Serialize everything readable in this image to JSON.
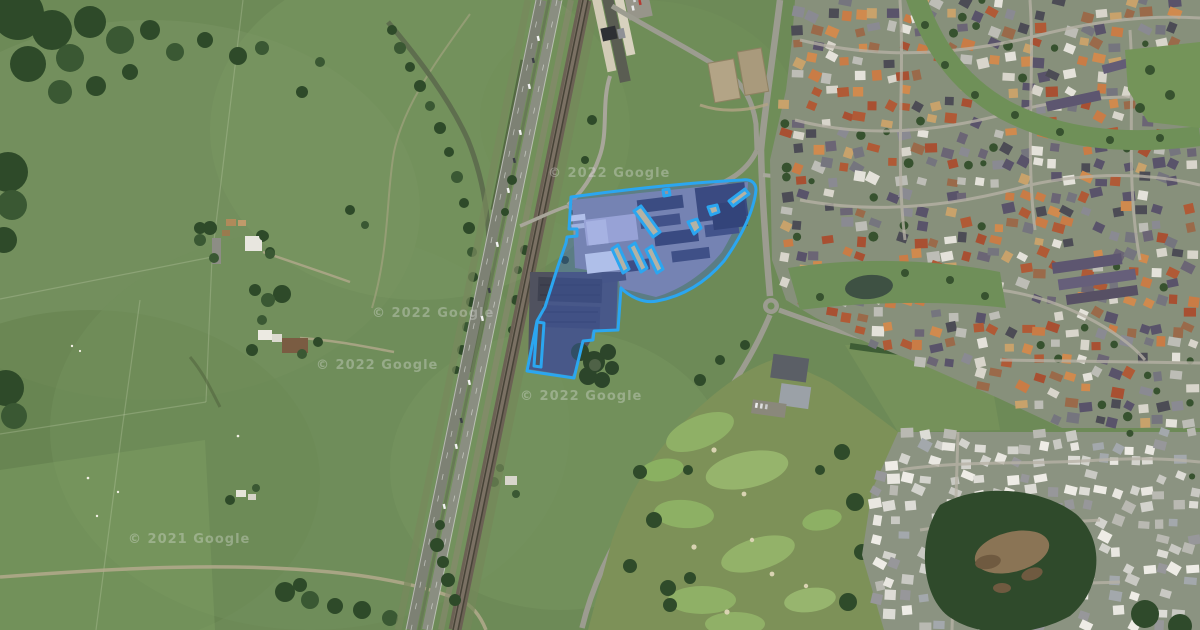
{
  "map": {
    "description": "satellite-aerial-view-with-highlighted-property",
    "watermarks": [
      {
        "text": "© 2022 Google",
        "x": 372,
        "y": 317
      },
      {
        "text": "© 2022 Google",
        "x": 316,
        "y": 369
      },
      {
        "text": "© 2022 Google",
        "x": 520,
        "y": 400
      },
      {
        "text": "© 2021 Google",
        "x": 128,
        "y": 543
      },
      {
        "text": "© 2022 Google",
        "x": 548,
        "y": 177
      }
    ],
    "parcel": {
      "label": "property-boundary",
      "stroke": "#2ba6f0",
      "fill": "rgba(58,100,220,0.34)",
      "path": "M571,197 C635,188 700,182 742,180 C750,179 756,182 756,190 C754,210 742,236 724,261 C706,282 684,296 657,301 C643,304 629,296 621,288 L618,330 L594,331 L593,340 L583,341 L574,378 L527,371 L537,321 L545,307 L558,266 L566,243 L567,237 L577,236 L577,229 L569,229 Z M729,201 L745,189 L749,194 L733,206 Z M634,211 L641,206 L660,232 L653,237 Z M612,249 L618,245 L629,269 L623,273 Z M629,247 L635,243 L647,268 L641,272 Z M646,250 L652,246 L663,269 L657,273 Z M688,222 L697,219 L701,228 L694,234 Z M708,207 L717,205 L719,212 L711,215 Z M663,190 L669,189 L670,195 L664,196 Z M537,322 L544,323 L541,367 L534,366 Z"
    },
    "suburb": {
      "seed": 7,
      "tree_color": "#37522f",
      "regions": [
        {
          "polygon": [
            [
              795,
              0
            ],
            [
              1200,
              0
            ],
            [
              1200,
              428
            ],
            [
              1062,
              428
            ],
            [
              998,
              398
            ],
            [
              930,
              368
            ],
            [
              866,
              342
            ],
            [
              816,
              318
            ],
            [
              786,
              300
            ],
            [
              772,
              260
            ],
            [
              770,
              160
            ],
            [
              786,
              90
            ],
            [
              792,
              40
            ]
          ],
          "step": 15,
          "skip": 0.26,
          "tree_chance": 0.06,
          "palette": [
            "#b05a36",
            "#c97c46",
            "#d08a4e",
            "#8a8a92",
            "#59536a",
            "#6b6575",
            "#d8d5cb",
            "#c8a26b",
            "#4c4c55",
            "#9a6a4a",
            "#e4e2da",
            "#75757e",
            "#a85032",
            "#bdbdb6"
          ]
        },
        {
          "polygon": [
            [
              898,
              432
            ],
            [
              1200,
              432
            ],
            [
              1200,
              630
            ],
            [
              884,
              630
            ],
            [
              862,
              555
            ],
            [
              872,
              490
            ]
          ],
          "step": 15,
          "skip": 0.3,
          "tree_chance": 0.04,
          "palette": [
            "#e9e7e1",
            "#dddcd6",
            "#c9c9c3",
            "#a3a8ac",
            "#d3d3cd",
            "#eeece6",
            "#97979a",
            "#b9b9b2"
          ]
        }
      ]
    }
  }
}
